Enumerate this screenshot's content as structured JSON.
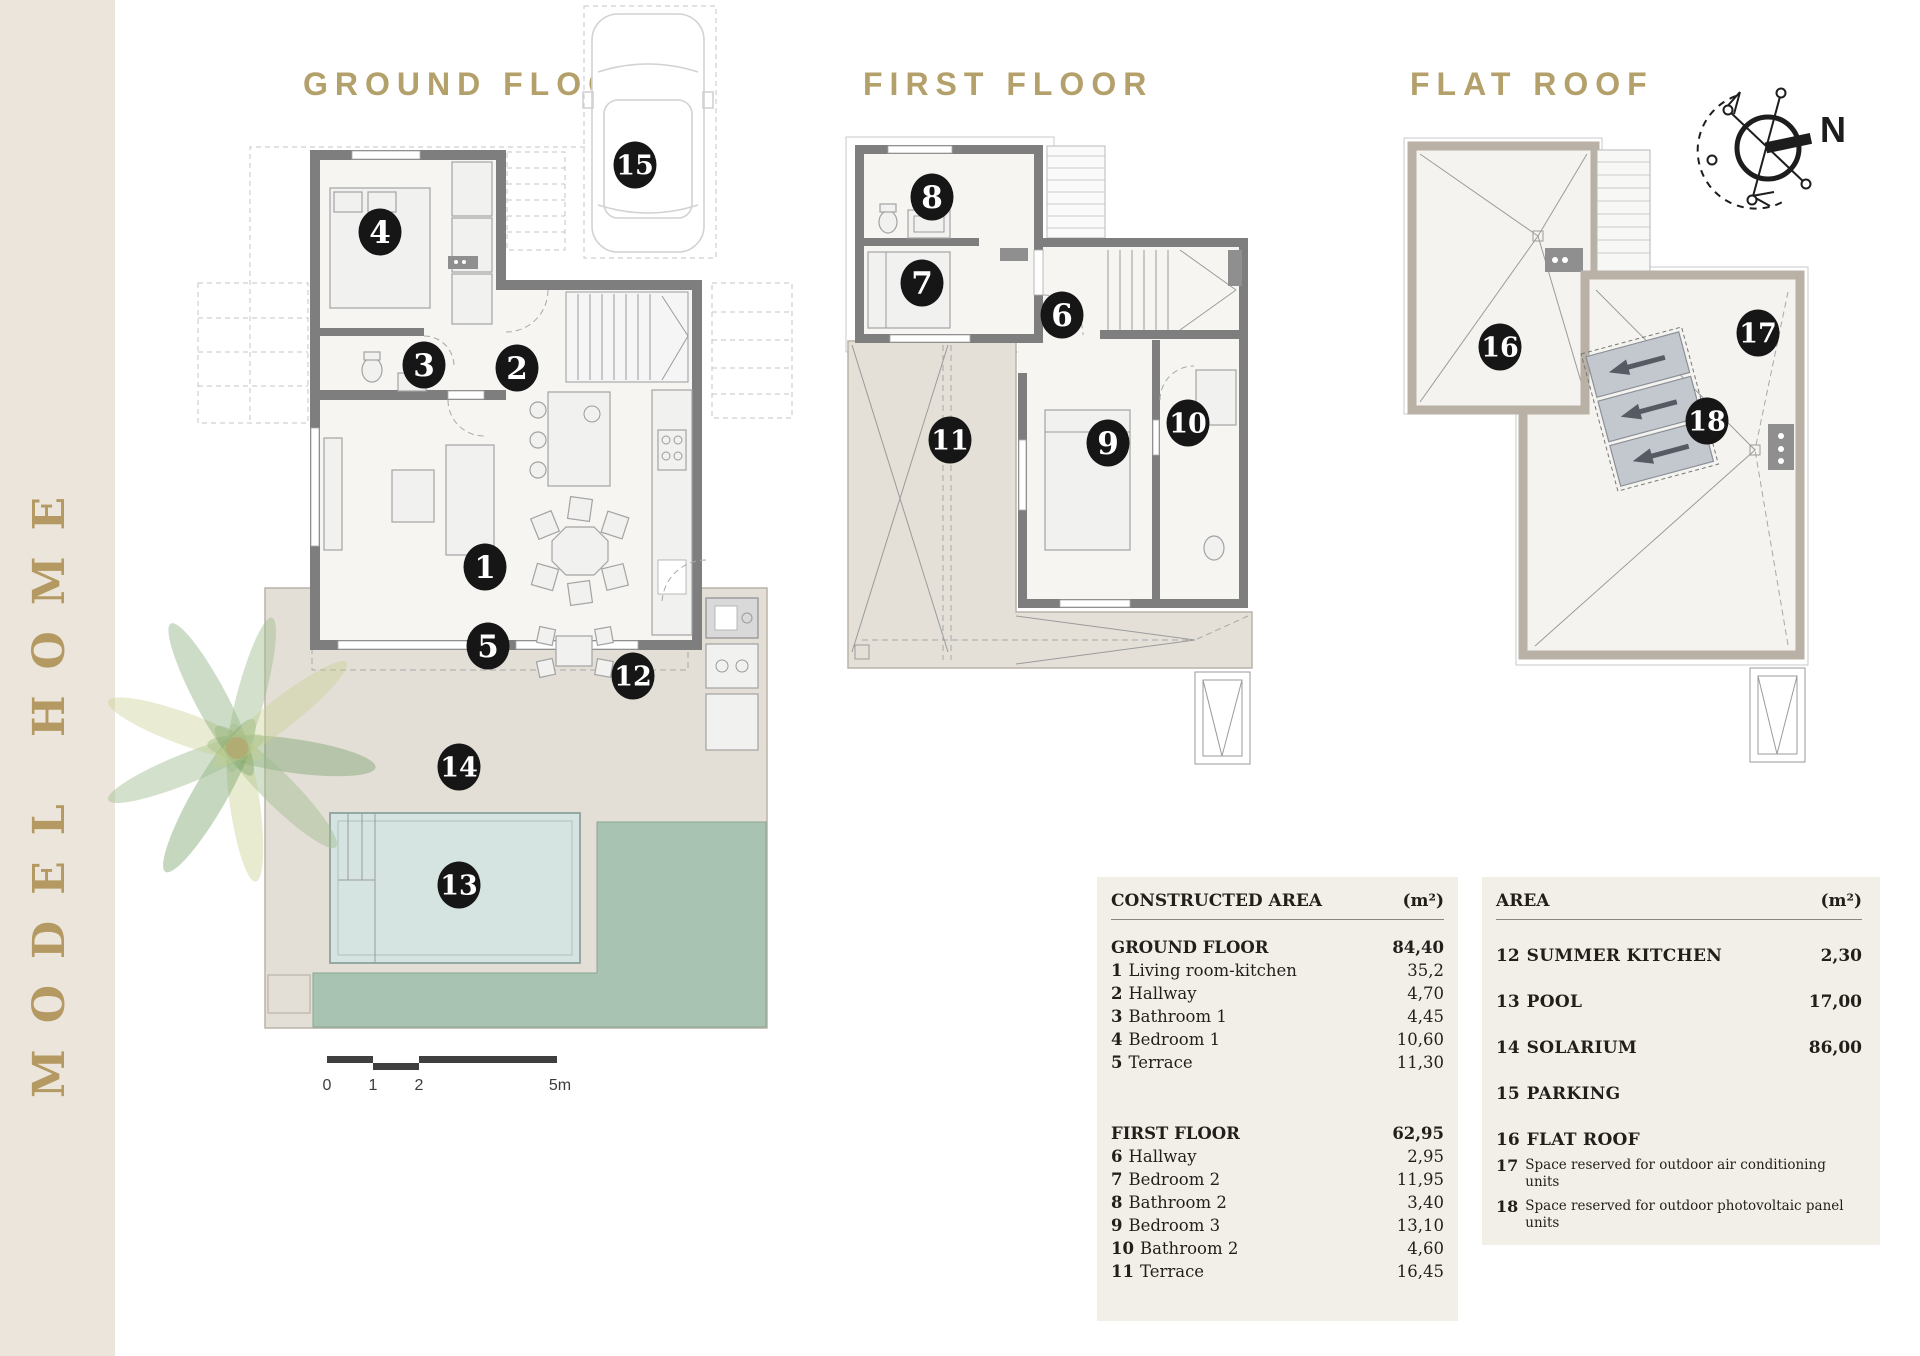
{
  "sidebar": {
    "vertical_title": "MODEL HOME"
  },
  "plans": [
    {
      "id": "ground",
      "title": "GROUND FLOOR"
    },
    {
      "id": "first",
      "title": "FIRST FLOOR"
    },
    {
      "id": "roof",
      "title": "FLAT ROOF"
    }
  ],
  "compass": {
    "label": "N"
  },
  "scale_bar": {
    "labels": [
      "0",
      "1",
      "2",
      "5m"
    ]
  },
  "markers": {
    "ground": [
      {
        "n": "1",
        "x": 485,
        "y": 567
      },
      {
        "n": "2",
        "x": 517,
        "y": 368
      },
      {
        "n": "3",
        "x": 424,
        "y": 365
      },
      {
        "n": "4",
        "x": 380,
        "y": 232
      },
      {
        "n": "5",
        "x": 488,
        "y": 646
      },
      {
        "n": "12",
        "x": 633,
        "y": 676
      },
      {
        "n": "13",
        "x": 459,
        "y": 885
      },
      {
        "n": "14",
        "x": 459,
        "y": 767
      },
      {
        "n": "15",
        "x": 635,
        "y": 165
      }
    ],
    "first": [
      {
        "n": "6",
        "x": 1062,
        "y": 315
      },
      {
        "n": "7",
        "x": 922,
        "y": 283
      },
      {
        "n": "8",
        "x": 932,
        "y": 197
      },
      {
        "n": "9",
        "x": 1108,
        "y": 443
      },
      {
        "n": "10",
        "x": 1188,
        "y": 423
      },
      {
        "n": "11",
        "x": 950,
        "y": 440
      }
    ],
    "roof": [
      {
        "n": "16",
        "x": 1500,
        "y": 347
      },
      {
        "n": "17",
        "x": 1758,
        "y": 333
      },
      {
        "n": "18",
        "x": 1707,
        "y": 421
      }
    ]
  },
  "tables": {
    "constructed": {
      "header": {
        "label": "CONSTRUCTED AREA",
        "unit": "(m²)"
      },
      "sections": [
        {
          "title": "GROUND FLOOR",
          "total": "84,40",
          "rows": [
            {
              "num": "1",
              "label": "Living room-kitchen",
              "value": "35,2"
            },
            {
              "num": "2",
              "label": "Hallway",
              "value": "4,70"
            },
            {
              "num": "3",
              "label": "Bathroom 1",
              "value": "4,45"
            },
            {
              "num": "4",
              "label": "Bedroom 1",
              "value": "10,60"
            },
            {
              "num": "5",
              "label": "Terrace",
              "value": "11,30"
            }
          ]
        },
        {
          "title": "FIRST FLOOR",
          "total": "62,95",
          "rows": [
            {
              "num": "6",
              "label": "Hallway",
              "value": "2,95"
            },
            {
              "num": "7",
              "label": "Bedroom 2",
              "value": "11,95"
            },
            {
              "num": "8",
              "label": "Bathroom 2",
              "value": "3,40"
            },
            {
              "num": "9",
              "label": "Bedroom 3",
              "value": "13,10"
            },
            {
              "num": "10",
              "label": "Bathroom 2",
              "value": "4,60"
            },
            {
              "num": "11",
              "label": "Terrace",
              "value": "16,45"
            }
          ]
        }
      ]
    },
    "area": {
      "header": {
        "label": "AREA",
        "unit": "(m²)"
      },
      "rows": [
        {
          "num": "12",
          "label": "SUMMER KITCHEN",
          "value": "2,30"
        },
        {
          "num": "13",
          "label": "POOL",
          "value": "17,00"
        },
        {
          "num": "14",
          "label": "SOLARIUM",
          "value": "86,00"
        },
        {
          "num": "15",
          "label": "PARKING",
          "value": ""
        },
        {
          "num": "16",
          "label": "FLAT ROOF",
          "value": ""
        }
      ],
      "notes": [
        {
          "num": "17",
          "text": "Space reserved for outdoor air conditioning units"
        },
        {
          "num": "18",
          "text": "Space reserved for outdoor photovoltaic panel units"
        }
      ]
    }
  },
  "colors": {
    "sidebar_bg": "#ebe5db",
    "gold": "#b3a06a",
    "wall": "#7e7e7e",
    "roof_wall": "#b9b1a5",
    "terrace": "#e3dfd7",
    "pool": "#d6e4e1",
    "grass": "#a9c3b2",
    "panel_bg": "#f2efe9",
    "marker": "#161616",
    "solar_panel": "#c3c8cf"
  }
}
